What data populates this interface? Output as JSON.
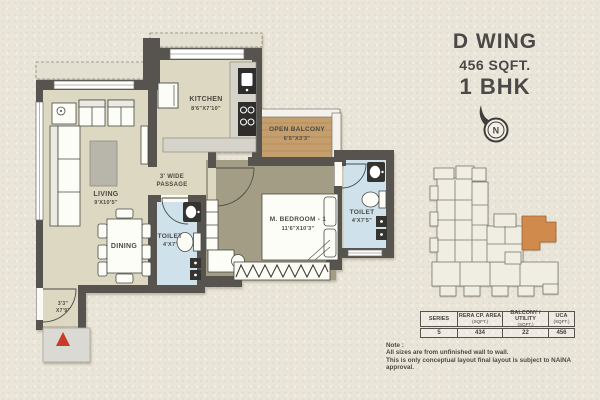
{
  "title": {
    "wing": "D WING",
    "area": "456 SQFT.",
    "type": "1 BHK"
  },
  "compass": {
    "label": "N"
  },
  "plan": {
    "rooms": {
      "living": {
        "name": "LIVING",
        "dims": "9'X10'5\""
      },
      "dining": {
        "name": "DINING"
      },
      "kitchen": {
        "name": "KITCHEN",
        "dims": "8'6\"X7'10\""
      },
      "open_balcony": {
        "name": "OPEN BALCONY",
        "dims": "6'5\"X3'3\""
      },
      "passage": {
        "line1": "3' WIDE",
        "line2": "PASSAGE"
      },
      "m_bedroom": {
        "name": "M. BEDROOM - 1",
        "dims": "11'6\"X10'3\""
      },
      "toilet_1": {
        "name": "TOILET",
        "dims": "4'X7'"
      },
      "toilet_2": {
        "name": "TOILET",
        "dims": "4'X7'5\""
      },
      "entry_foyer": {
        "dims_line1": "3'3\"",
        "dims_line2": "X7'9\""
      }
    }
  },
  "area_table": {
    "headers": [
      {
        "label": "SERIES",
        "sub": ""
      },
      {
        "label": "RERA CP. AREA",
        "sub": "(SQFT.)"
      },
      {
        "label": "BALCONY / UTILITY",
        "sub": "(SQFT.)"
      },
      {
        "label": "UCA",
        "sub": "(SQFT.)"
      }
    ],
    "values": [
      "5",
      "434",
      "22",
      "456"
    ]
  },
  "note": {
    "line1": "Note :",
    "line2": "All sizes are from unfinished wall to wall.",
    "line3": "This is only conceptual layout final layout is subject to NAINA approval."
  },
  "colors": {
    "paper": "#e9e5d8",
    "wall": "#575450",
    "floor": "#dcd8c2",
    "bedroom_floor": "#a49d85",
    "toilet_floor": "#cfe2ec",
    "balcony_wood": "#c49e6c",
    "counter": "#d6d3ca",
    "highlight_unit": "#cf8a4c",
    "entry_arrow": "#c93a28",
    "text": "#4b4a44"
  }
}
